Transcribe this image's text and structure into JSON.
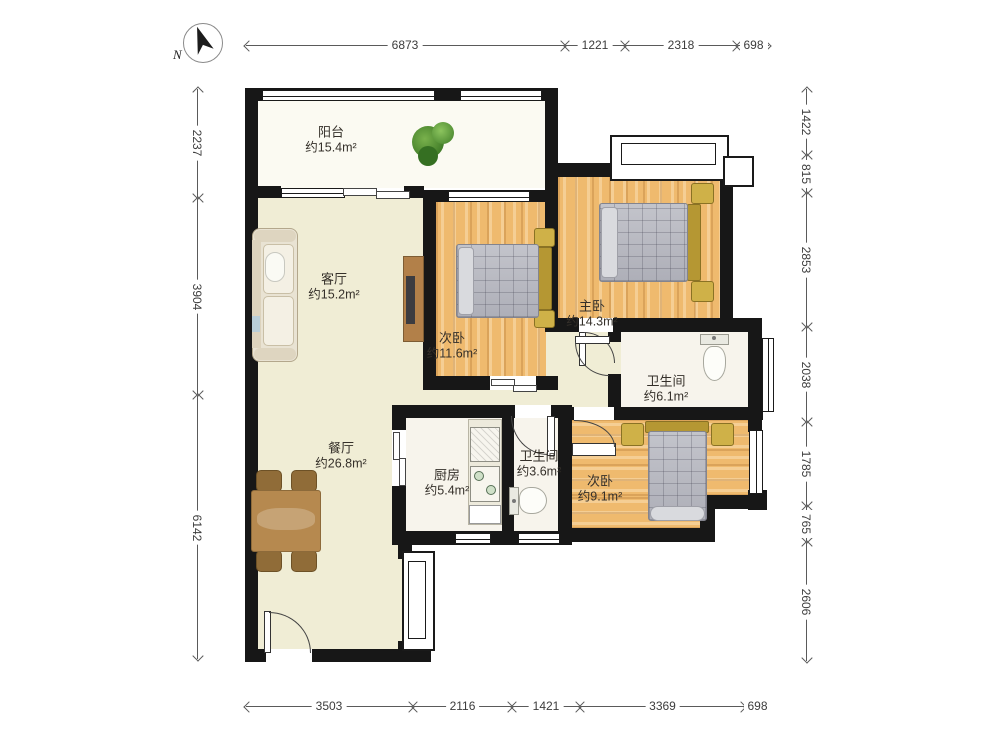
{
  "compass": {
    "north_label": "N"
  },
  "rooms": [
    {
      "name": "阳台",
      "area": "约15.4m²"
    },
    {
      "name": "客厅",
      "area": "约15.2m²"
    },
    {
      "name": "次卧",
      "area": "约11.6m²"
    },
    {
      "name": "主卧",
      "area": "约14.3m²"
    },
    {
      "name": "卫生间",
      "area": "约6.1m²"
    },
    {
      "name": "餐厅",
      "area": "约26.8m²"
    },
    {
      "name": "厨房",
      "area": "约5.4m²"
    },
    {
      "name": "卫生间",
      "area": "约3.6m²"
    },
    {
      "name": "次卧",
      "area": "约9.1m²"
    }
  ],
  "dimensions": {
    "top": {
      "orientation": "horizontal",
      "y": 45,
      "bounds": [
        245,
        565,
        625,
        737,
        770
      ],
      "labels": [
        "6873",
        "1221",
        "2318",
        "698"
      ]
    },
    "bottom": {
      "orientation": "horizontal",
      "y": 706,
      "bounds": [
        245,
        413,
        512,
        580,
        745,
        770
      ],
      "labels": [
        "3503",
        "2116",
        "1421",
        "3369",
        "698"
      ]
    },
    "left": {
      "orientation": "vertical",
      "x": 197,
      "bounds": [
        88,
        198,
        395,
        660
      ],
      "labels": [
        "2237",
        "3904",
        "6142"
      ]
    },
    "right": {
      "orientation": "vertical",
      "x": 806,
      "bounds": [
        88,
        155,
        193,
        327,
        422,
        506,
        542,
        662
      ],
      "labels": [
        "1422",
        "815",
        "2853",
        "2038",
        "1785",
        "765",
        "2606"
      ]
    }
  },
  "colors": {
    "wall": "#171717",
    "floor_public": "#f0edd5",
    "floor_wood": "#efba6e",
    "floor_wet": "#f7f4ec",
    "floor_balcony": "#fbfaf2",
    "furniture_wood": "#b6894f",
    "bed_fabric": "#b9bac2",
    "headboard": "#b59733",
    "nightstand": "#cfb148",
    "plant_green": "#4e8f2f",
    "dimension_text": "#3c3c3c"
  }
}
